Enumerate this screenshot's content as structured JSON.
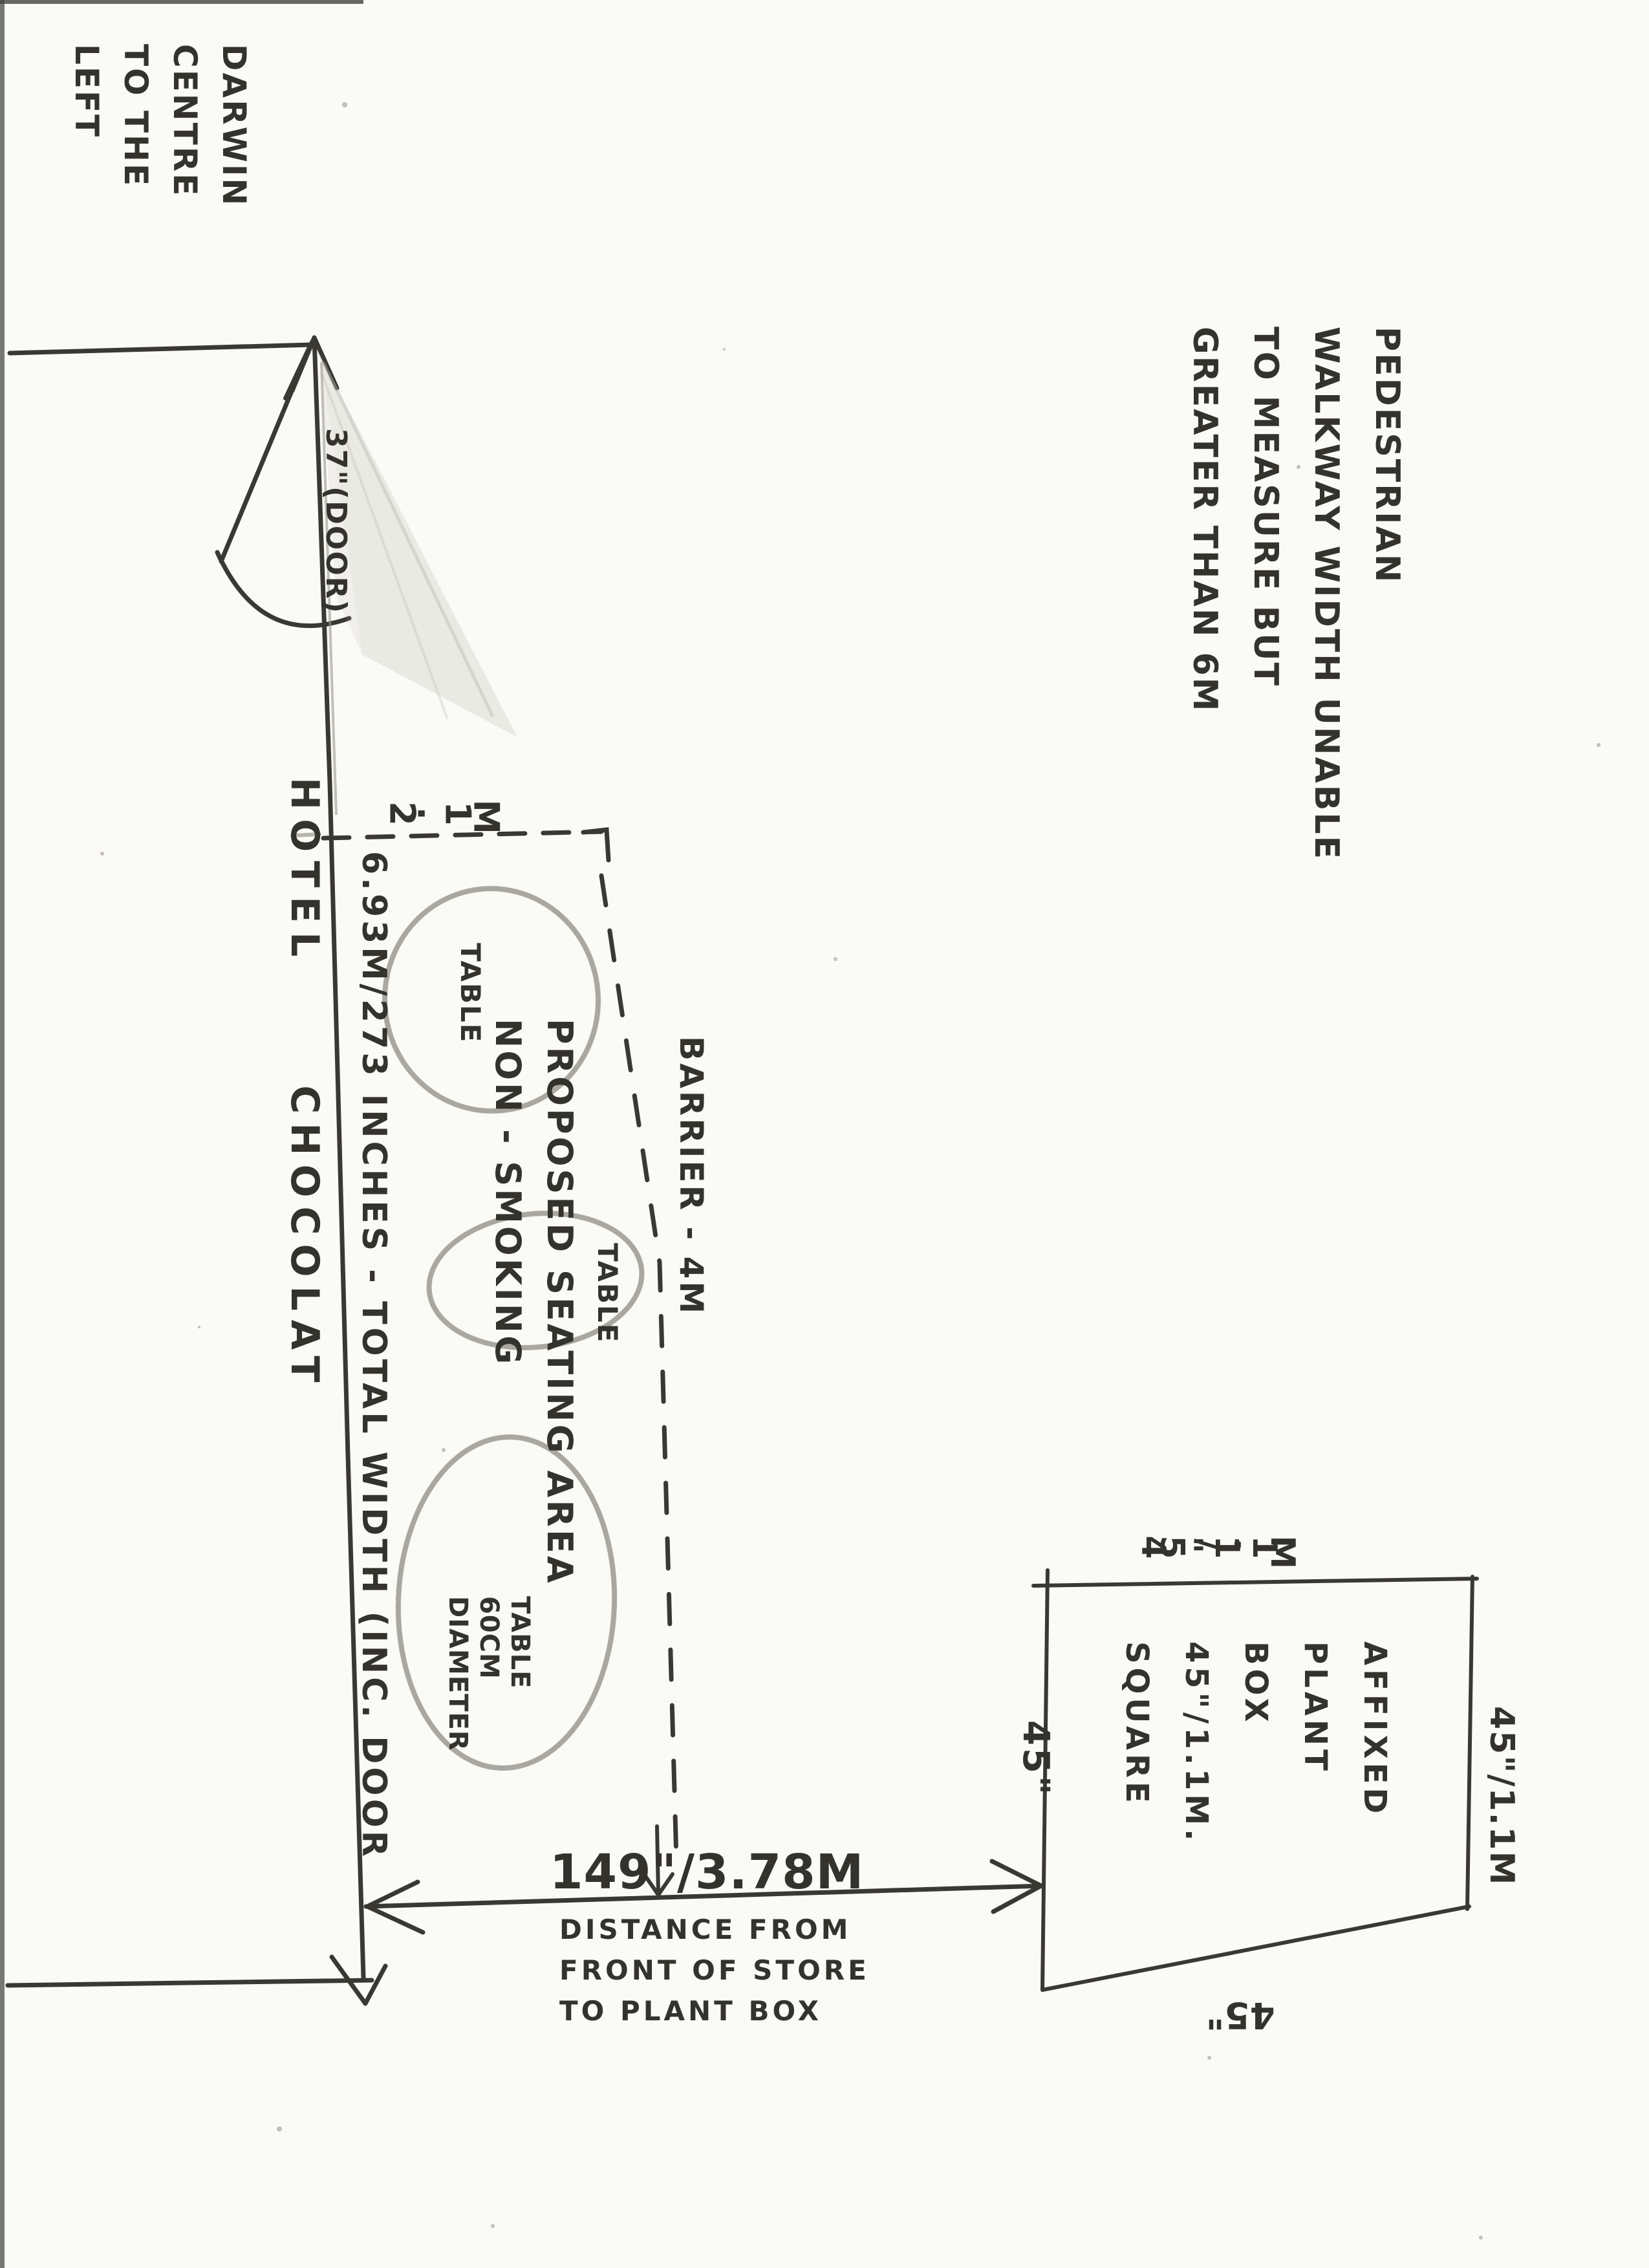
{
  "colors": {
    "ink": "#34322d",
    "pencil": "#a09e96",
    "paper": "#fafaf6"
  },
  "notes": {
    "darwin": {
      "lines": [
        "DARWIN",
        "CENTRE",
        "TO THE",
        "LEFT"
      ]
    },
    "walkway": {
      "lines": [
        "PEDESTRIAN",
        "WALKWAY WIDTH UNABLE",
        "TO MEASURE BUT",
        "GREATER THAN 6M"
      ]
    }
  },
  "store": {
    "name": "HOTEL CHOCOLAT",
    "door_label": "37\"(DOOR)",
    "front_width_label": "6.93M/273 INCHES - TOTAL WIDTH (INC. DOOR"
  },
  "seating_area": {
    "title": "PROPOSED SEATING AREA",
    "subtitle": "NON - SMOKING",
    "top_width_label": "2.1M",
    "barrier_label": "BARRIER - 4M",
    "table1_label": "TABLE",
    "table2_label": "TABLE",
    "table3": {
      "lines": [
        "TABLE",
        "60CM",
        "DIAMETER"
      ]
    }
  },
  "distance": {
    "value": "149\"/3.78M",
    "caption": [
      "DISTANCE FROM",
      "FRONT OF STORE",
      "TO PLANT BOX"
    ]
  },
  "plant_box": {
    "label_top": "45\"/1.1M",
    "label_right": "45\"/1.1M",
    "label_left": "45\"",
    "label_bottom": "45\"",
    "text_lines": [
      "AFFIXED",
      "PLANT",
      "BOX",
      "45\"/1.1M.",
      "SQUARE"
    ]
  }
}
